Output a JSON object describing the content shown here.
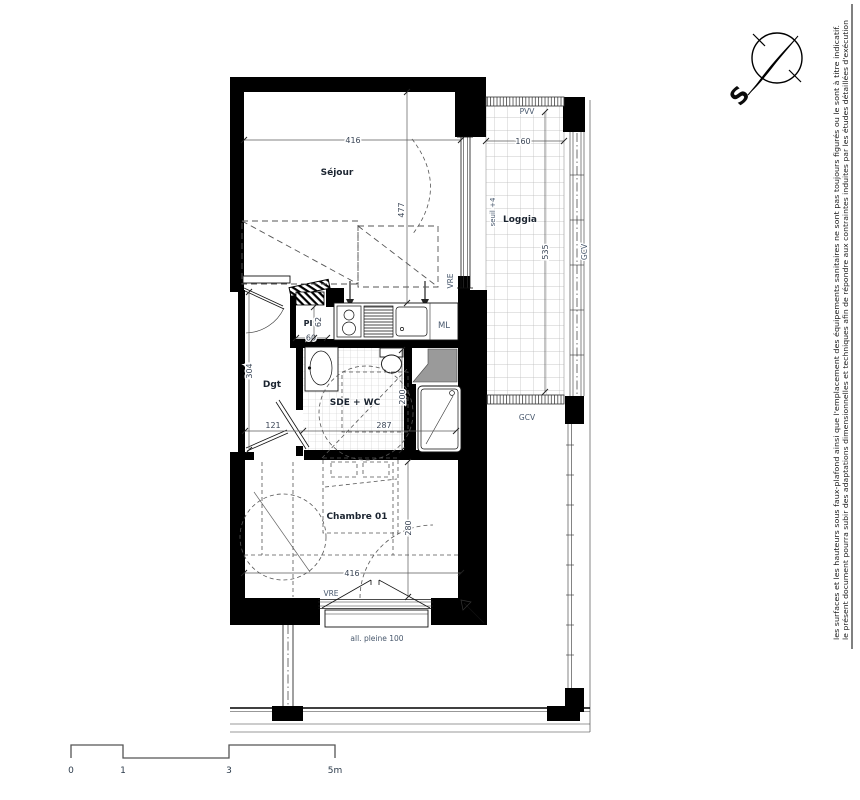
{
  "plan": {
    "rooms": {
      "sejour": "Séjour",
      "loggia": "Loggia",
      "chambre": "Chambre 01",
      "sde": "SDE + WC",
      "dgt": "Dgt",
      "pi": "PI",
      "ml": "ML"
    },
    "openings": {
      "pvv": "PVV",
      "vre_bay": "VRE",
      "vre_window": "VRE",
      "gcv_loggia": "GCV",
      "gcv_rail": "GCV",
      "seuil": "seuil +4",
      "allege": "all. pleine 100"
    },
    "dims": {
      "sejour_w": "416",
      "sejour_d": "477",
      "loggia_w": "160",
      "loggia_d": "535",
      "dgt_d": "304",
      "dgt_w": "121",
      "sde_w": "287",
      "sde_d": "200",
      "pi_w": "60",
      "pi_d": "62",
      "chambre_d": "280",
      "chambre_w": "416"
    }
  },
  "compass": {
    "south": "S"
  },
  "scale_bar": {
    "t0": "0",
    "t1": "1",
    "t3": "3",
    "t5": "5m"
  },
  "disclaimer": {
    "line1": "le présent document pourra subir des adaptations dimensionnelles et techniques afin de répondre aux contraintes induites par les études détaillées d'exécution",
    "line2": "les surfaces et les hauteurs sous faux-plafond ainsi que l'emplacement des équipements sanitaires ne sont pas toujours figurés ou le sont à titre indicatif."
  },
  "colors": {
    "wall": "#000000",
    "tile": "#c9c9c9",
    "loggia_tile": "#b9b9b9",
    "label": "#1b2430",
    "dim": "#3a4556"
  }
}
